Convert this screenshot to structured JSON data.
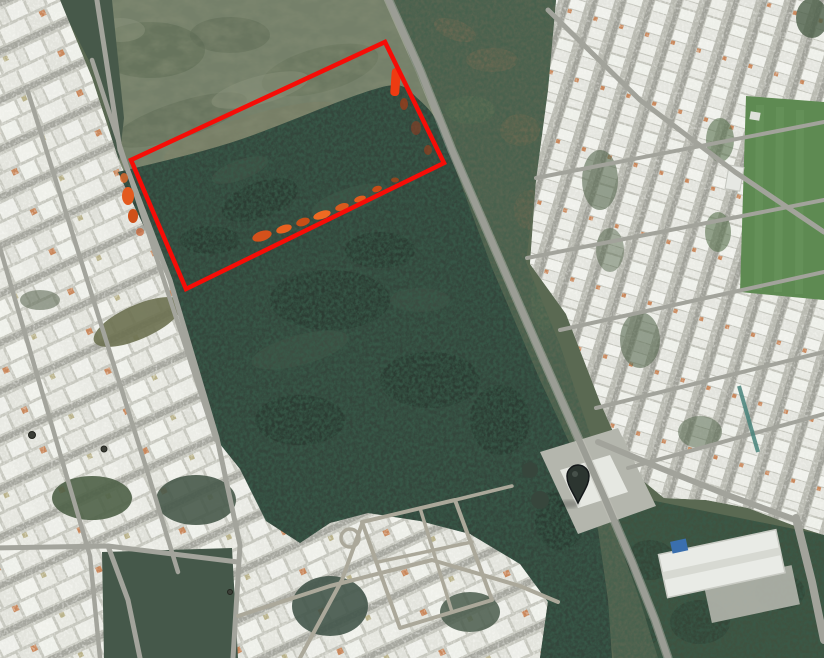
{
  "map": {
    "boundary_overlay": {
      "points": "385,42 444,163 186,289 131,160",
      "stroke_color": "#f60d07",
      "stroke_width": 4.5
    },
    "marker": {
      "transform": "translate(578,503)",
      "fill": "#2c3530",
      "stroke": "#14181a"
    },
    "palette": {
      "base_green": "#5a6952",
      "field": "#75806a",
      "forest": "#34463c",
      "forest_deep": "#243129",
      "scrub": "#566551",
      "urban_base": "#c6c7be",
      "house_white": "#eceee8",
      "road_gray": "#9b9d95",
      "dirt_road": "#aba89a",
      "park_green": "#5e8a52",
      "trees_green": "#47594a",
      "bottom_trees": "#3f5240",
      "canal_teal": "#47837a",
      "burn_orange": "#e8581c",
      "burn_red": "#ee3b12",
      "warehouse_white": "#e9ebe6",
      "warehouse_blue": "#3a6fae",
      "facility_pad": "#b4b6ad"
    }
  }
}
